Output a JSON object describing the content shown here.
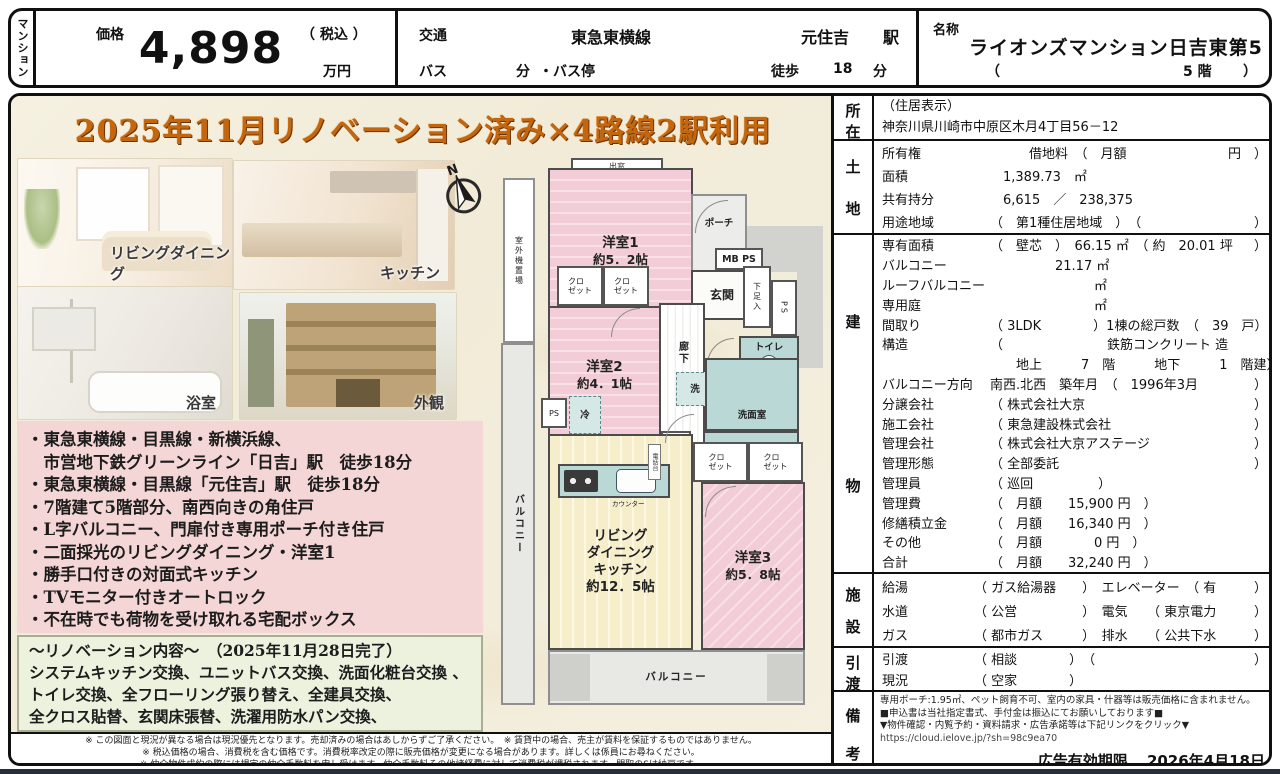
{
  "header": {
    "tab": "マンション",
    "price": {
      "label": "価格",
      "tax": "（ 税込 ）",
      "value": "4,898",
      "unit": "万円"
    },
    "transport": {
      "label": "交通",
      "line": "東急東横線",
      "station": "元住吉",
      "station_unit": "駅",
      "bus": "バス",
      "bus_min": "分",
      "bus_stop": "・バス停",
      "walk": "徒歩",
      "walk_min": "18",
      "walk_unit": "分"
    },
    "name": {
      "label": "名称",
      "value": "ライオンズマンション日吉東第5",
      "paren_open": "（",
      "floor": "5 階",
      "paren_close": "）"
    }
  },
  "promo": {
    "banner": "2025年11月リノベーション済み×4路線2駅利用可",
    "captions": {
      "living": "リビングダイニング",
      "kitchen": "キッチン",
      "bath": "浴室",
      "exterior": "外観"
    },
    "features": [
      "・東急東横線・目黒線・新横浜線、",
      "　市営地下鉄グリーンライン「日吉」駅　徒歩18分",
      "・東急東横線・目黒線「元住吉」駅　徒歩18分",
      "・7階建て5階部分、南西向きの角住戸",
      "・L字バルコニー、門扉付き専用ポーチ付き住戸",
      "・二面採光のリビングダイニング・洋室1",
      "・勝手口付きの対面式キッチン",
      "・TVモニター付きオートロック",
      "・不在時でも荷物を受け取れる宅配ボックス"
    ],
    "renovation": {
      "title": "～リノベーション内容～　（2025年11月28日完了）",
      "lines": [
        "システムキッチン交換、ユニットバス交換、洗面化粧台交換 、",
        "トイレ交換、全フローリング張り替え、全建具交換、",
        "全クロス貼替、玄関床張替、洗濯用防水パン交換、"
      ]
    }
  },
  "floorplan": {
    "bay_window": "出窓",
    "outdoor_unit": "室外機置場",
    "balcony_left": "バルコニー",
    "balcony_bottom": "バルコニー",
    "room1_name": "洋室1",
    "room1_size": "約5．2帖",
    "room2_name": "洋室2",
    "room2_size": "約4．1帖",
    "room3_name": "洋室3",
    "room3_size": "約5．8帖",
    "ldk_lines": [
      "リビング",
      "ダイニング",
      "キッチン",
      "約12．5帖"
    ],
    "porch": "ポーチ",
    "mbps": "MB PS",
    "entrance": "玄関",
    "shoe_box": "下足入",
    "ps": "PS",
    "ps_small": "PS",
    "toilet": "トイレ",
    "corridor": "廊下",
    "closet": "クロ\nゼット",
    "washer": "洗",
    "washroom": "洗面室",
    "bath": "浴室\n1317",
    "storage": "物入",
    "fridge": "冷",
    "counter": "カウンター",
    "phone_stand": "電話台",
    "compass_n": "N"
  },
  "details": {
    "address": {
      "label_chars": [
        "所",
        "在"
      ],
      "line1": "（住居表示）",
      "line2": "神奈川県川崎市中原区木月4丁目56－12"
    },
    "land": {
      "label_chars": [
        "土",
        "地"
      ],
      "rows": [
        {
          "label": "所有権",
          "value": "　　　借地料　（　月額",
          "end": "円　）"
        },
        {
          "label": "面積",
          "value": "　1,389.73　㎡"
        },
        {
          "label": "共有持分",
          "value": "　6,615　／　238,375"
        },
        {
          "label": "用途地域",
          "value": "（　第1種住居地域　）　（",
          "end": "）"
        }
      ]
    },
    "building": {
      "label_chars": [
        "建",
        "物"
      ],
      "rows": [
        {
          "label": "専有面積",
          "value": "（　壁芯　）　66.15 ㎡　（ 約　20.01 坪",
          "end": "）"
        },
        {
          "label": "バルコニー",
          "value": "　　　　　21.17 ㎡"
        },
        {
          "label": "ルーフバルコニー",
          "value": "　　　　　　　　㎡"
        },
        {
          "label": "専用庭",
          "value": "　　　　　　　　㎡"
        },
        {
          "label": "間取り",
          "value": "（ 3LDK　　　　）1棟の総戸数　（　39　戸",
          "end": "）"
        },
        {
          "label": "構造",
          "value": "（　　　　　　　　鉄筋コンクリート 造"
        },
        {
          "label": "",
          "value": "　　地上　　　7　階　　　地下　　　1　階建",
          "end": "）"
        },
        {
          "label": "バルコニー方向",
          "value": "南西.北西　築年月　（　1996年3月",
          "end": "）"
        },
        {
          "label": "分譲会社",
          "value": "（ 株式会社大京",
          "end": "）"
        },
        {
          "label": "施工会社",
          "value": "（ 東急建設株式会社",
          "end": "）"
        },
        {
          "label": "管理会社",
          "value": "（ 株式会社大京アステージ",
          "end": "）"
        },
        {
          "label": "管理形態",
          "value": "（ 全部委託",
          "end": "）"
        },
        {
          "label": "管理員",
          "value": "（ 巡回　　　　　）"
        },
        {
          "label": "管理費",
          "value": "（　月額　　15,900 円　）"
        },
        {
          "label": "修繕積立金",
          "value": "（　月額　　16,340 円　）"
        },
        {
          "label": "その他",
          "value": "（　月額　　　　0 円　）"
        },
        {
          "label": "合計",
          "value": "（　月額　　32,240 円　）"
        }
      ]
    },
    "facility": {
      "label_chars": [
        "施",
        "設"
      ],
      "rows": [
        {
          "label": "給湯",
          "value": "（ ガス給湯器　　）　エレベーター　（ 有",
          "end": "）"
        },
        {
          "label": "水道",
          "value": "（ 公営　　　　　）　電気　　（ 東京電力",
          "end": "）"
        },
        {
          "label": "ガス",
          "value": "（ 都市ガス　　　）　排水　　（ 公共下水",
          "end": "）"
        }
      ]
    },
    "handover": {
      "label_chars": [
        "引",
        "渡"
      ],
      "rows": [
        {
          "label": "引渡",
          "value": "（ 相談　　　　）　（",
          "end": "）"
        },
        {
          "label": "現況",
          "value": "（ 空家　　　　）"
        }
      ]
    },
    "remarks": {
      "label_chars": [
        "備",
        "考"
      ],
      "lines": [
        "専用ポーチ:1.95㎡、ペット飼育不可、室内の家具・什器等は販売価格に含まれません。",
        "■申込書は当社指定書式、手付金は振込にてお願いしております■",
        "▼物件確認・内覧予約・資料請求・広告承諾等は下記リンクをクリック▼"
      ],
      "link": "https://cloud.ielove.jp/?sh=98c9ea70",
      "expiry_label": "広告有効期限",
      "expiry_value": "2026年4月18日"
    }
  },
  "disclaimers": [
    "※ この図面と現況が異なる場合は現況優先となります。売却済みの場合はあしからずご了承ください。　※ 賃貸中の場合、売主が賃料を保証するものではありません。",
    "※ 税込価格の場合、消費税を含む価格です。消費税率改定の際に販売価格が変更になる場合があります。詳しくは係員にお尋ねください。",
    "※ 仲介物件成約の際には規定の仲介手数料を申し受けます。仲介手数料その他諸経費に対して消費税が課税されます。間取のSは納戸です。"
  ],
  "colors": {
    "banner_orange": "#c2660f",
    "feature_pink": "#f5d6d6",
    "renovation_green": "#edf2df",
    "room_pink": "#f2ccd6",
    "ldk_cream": "#f6eecb",
    "wet_teal": "#b9d8d6",
    "frame_black": "#101010"
  }
}
